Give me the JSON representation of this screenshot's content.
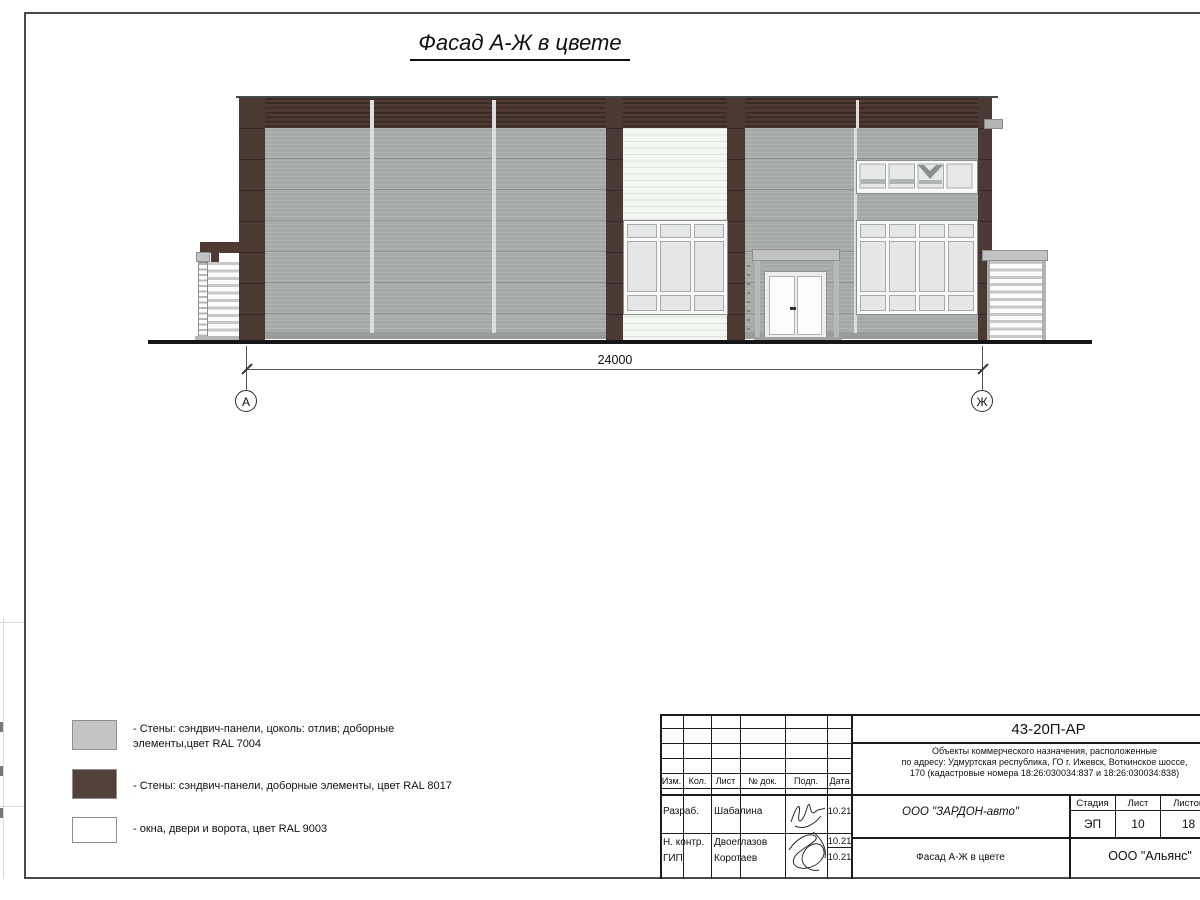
{
  "page": {
    "title": "Фасад А-Ж в цвете"
  },
  "drawing": {
    "dimension": {
      "value": "24000"
    },
    "axes": {
      "left": "А",
      "right": "Ж"
    }
  },
  "legend": {
    "items": [
      {
        "label": "- Стены: сэндвич-панели, цоколь: отлив; доборные элементы,цвет RAL 7004",
        "color": "#c2c5c4"
      },
      {
        "label": "- Стены: сэндвич-панели, доборные элементы, цвет RAL 8017",
        "color": "#54403a"
      },
      {
        "label": "- окна, двери и ворота, цвет RAL 9003",
        "color": "#ffffff"
      }
    ]
  },
  "colors": {
    "wall_gray": "#a6aaa9",
    "trim_brown": "#4d3933",
    "openings_white": "#f3f6f1"
  },
  "stamp": {
    "doc_number": "43-20П-АР",
    "description": {
      "line1": "Объекты коммерческого назначения, расположенные",
      "line2": "по адресу: Удмуртская республика, ГО г. Ижевск, Воткинское шоссе,",
      "line3": "170 (кадастровые номера 18:26:030034:837 и 18:26:030034:838)"
    },
    "company": "ООО \"ЗАРДОН-авто\"",
    "sheet_title": "Фасад А-Ж в цвете",
    "org": "ООО \"Альянс\"",
    "header_cols": {
      "izm": "Изм.",
      "kol": "Кол.",
      "list": "Лист",
      "doc": "№ док.",
      "podp": "Подп.",
      "data": "Дата"
    },
    "stage_header": {
      "stage": "Стадия",
      "sheet": "Лист",
      "sheets": "Листов"
    },
    "stage_values": {
      "stage": "ЭП",
      "sheet": "10",
      "sheets": "18"
    },
    "rows": [
      {
        "role": "Разраб.",
        "name": "Шабалина",
        "date": "10.21"
      },
      {
        "role": "Н. контр.",
        "name": "Двоеглазов",
        "date": "10.21"
      },
      {
        "role": "ГИП",
        "name": "Коротаев",
        "date": "10.21"
      }
    ]
  }
}
